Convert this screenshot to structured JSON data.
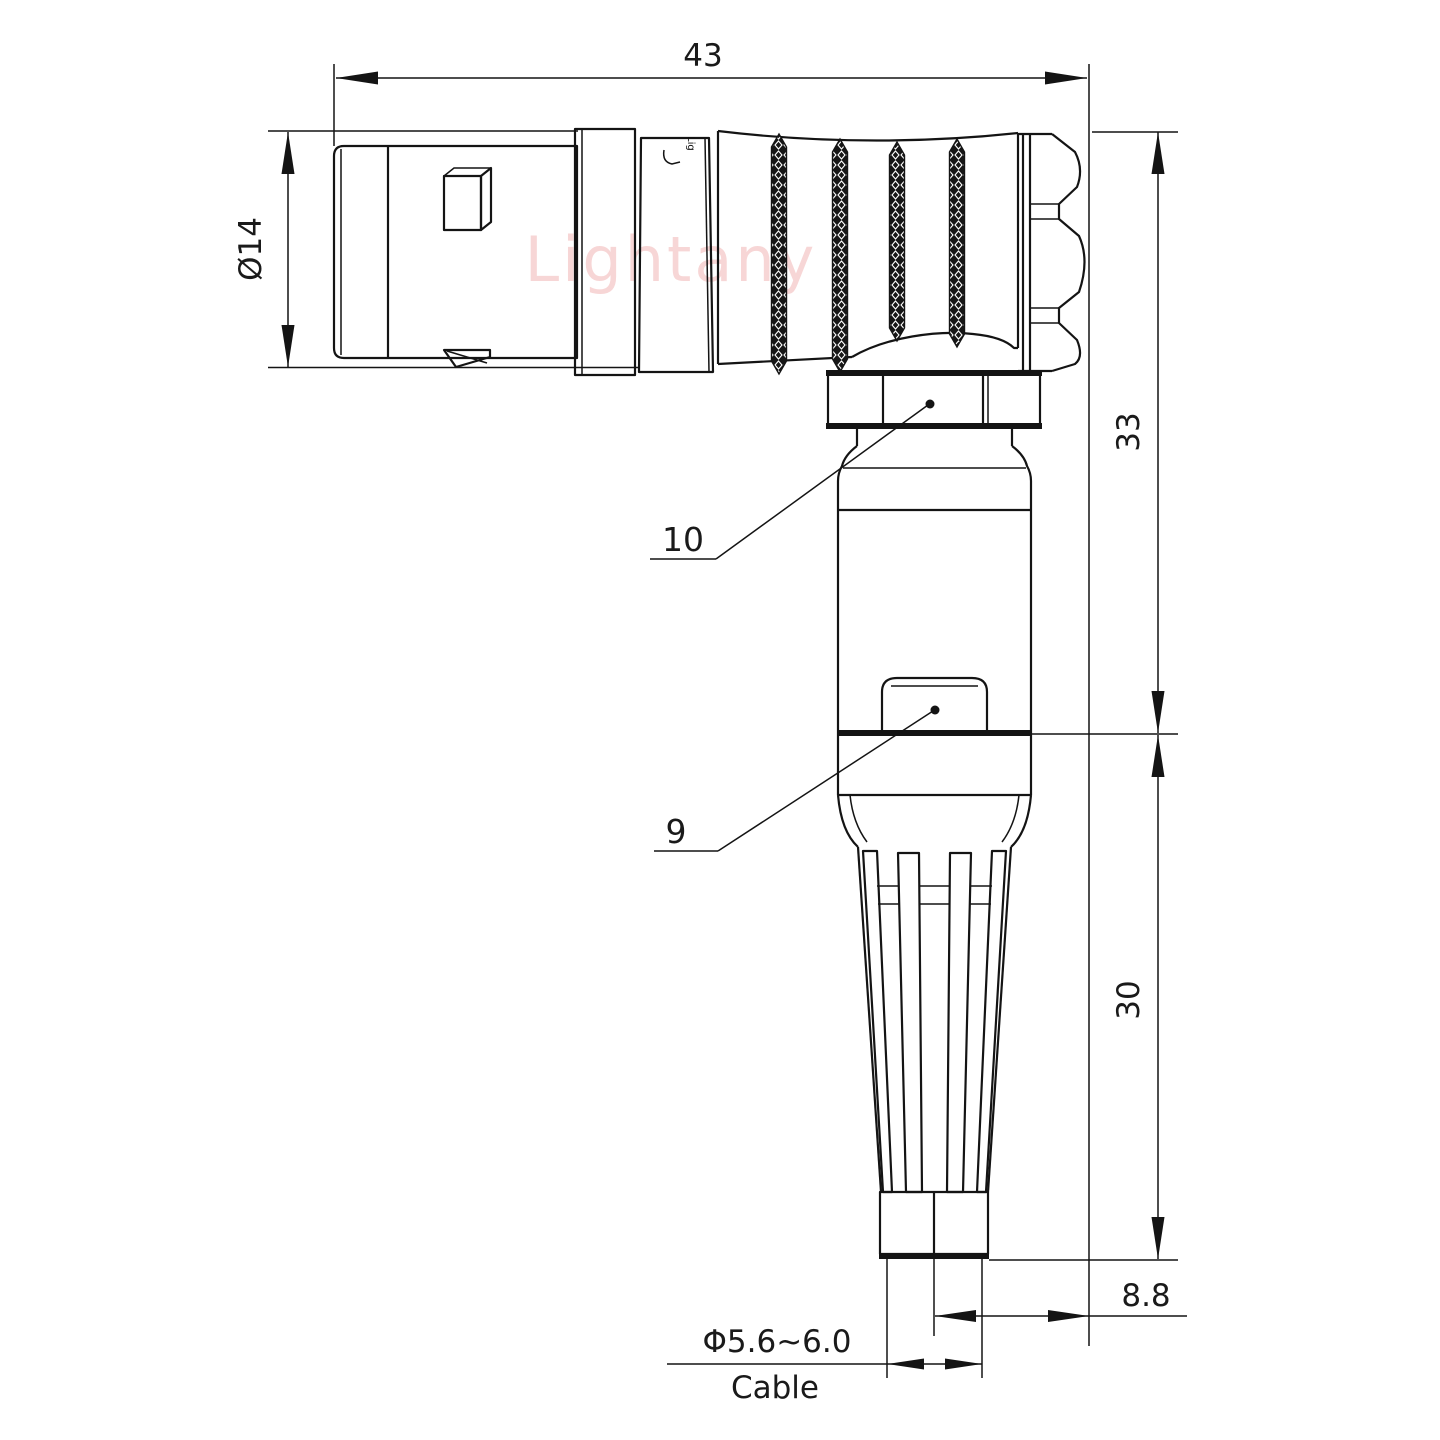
{
  "drawing": {
    "kind": "technical-drawing",
    "subject": "right-angle circular push-pull connector with cable strain relief, side elevation",
    "watermark": "Lightany",
    "body_marking": "Lig",
    "colors": {
      "line": "#141414",
      "watermark": "#ee9e9e",
      "background": "#ffffff"
    },
    "dimensions": {
      "overall_length": "43",
      "shell_diameter": "Ø14",
      "upper_height": "33",
      "lower_height": "30",
      "cable_offset": "8.8",
      "cable_diameter": "Φ5.6~6.0",
      "cable_word": "Cable"
    },
    "part_labels": {
      "coupling_nut": "10",
      "latch_sleeve": "9"
    }
  }
}
